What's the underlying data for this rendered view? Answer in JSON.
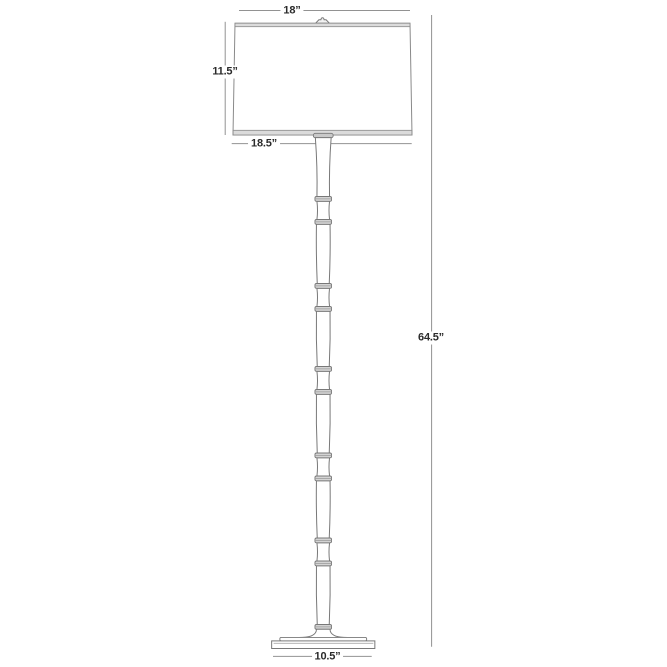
{
  "diagram": {
    "subject": "floor-lamp-dimension-line-drawing",
    "dimensions": {
      "shade_top_width": "18”",
      "shade_height": "11.5”",
      "shade_bottom_width": "18.5”",
      "total_height": "64.5”",
      "base_width": "10.5”"
    },
    "colors": {
      "dimension_line": "#929292",
      "lamp_outline": "#787878",
      "shade_band_fill": "#dbdbdb",
      "socket_fill": "#c9c9c9",
      "ring_fill": "#d4d4d4",
      "label_text": "#2b2b2b",
      "background": "#ffffff"
    }
  }
}
